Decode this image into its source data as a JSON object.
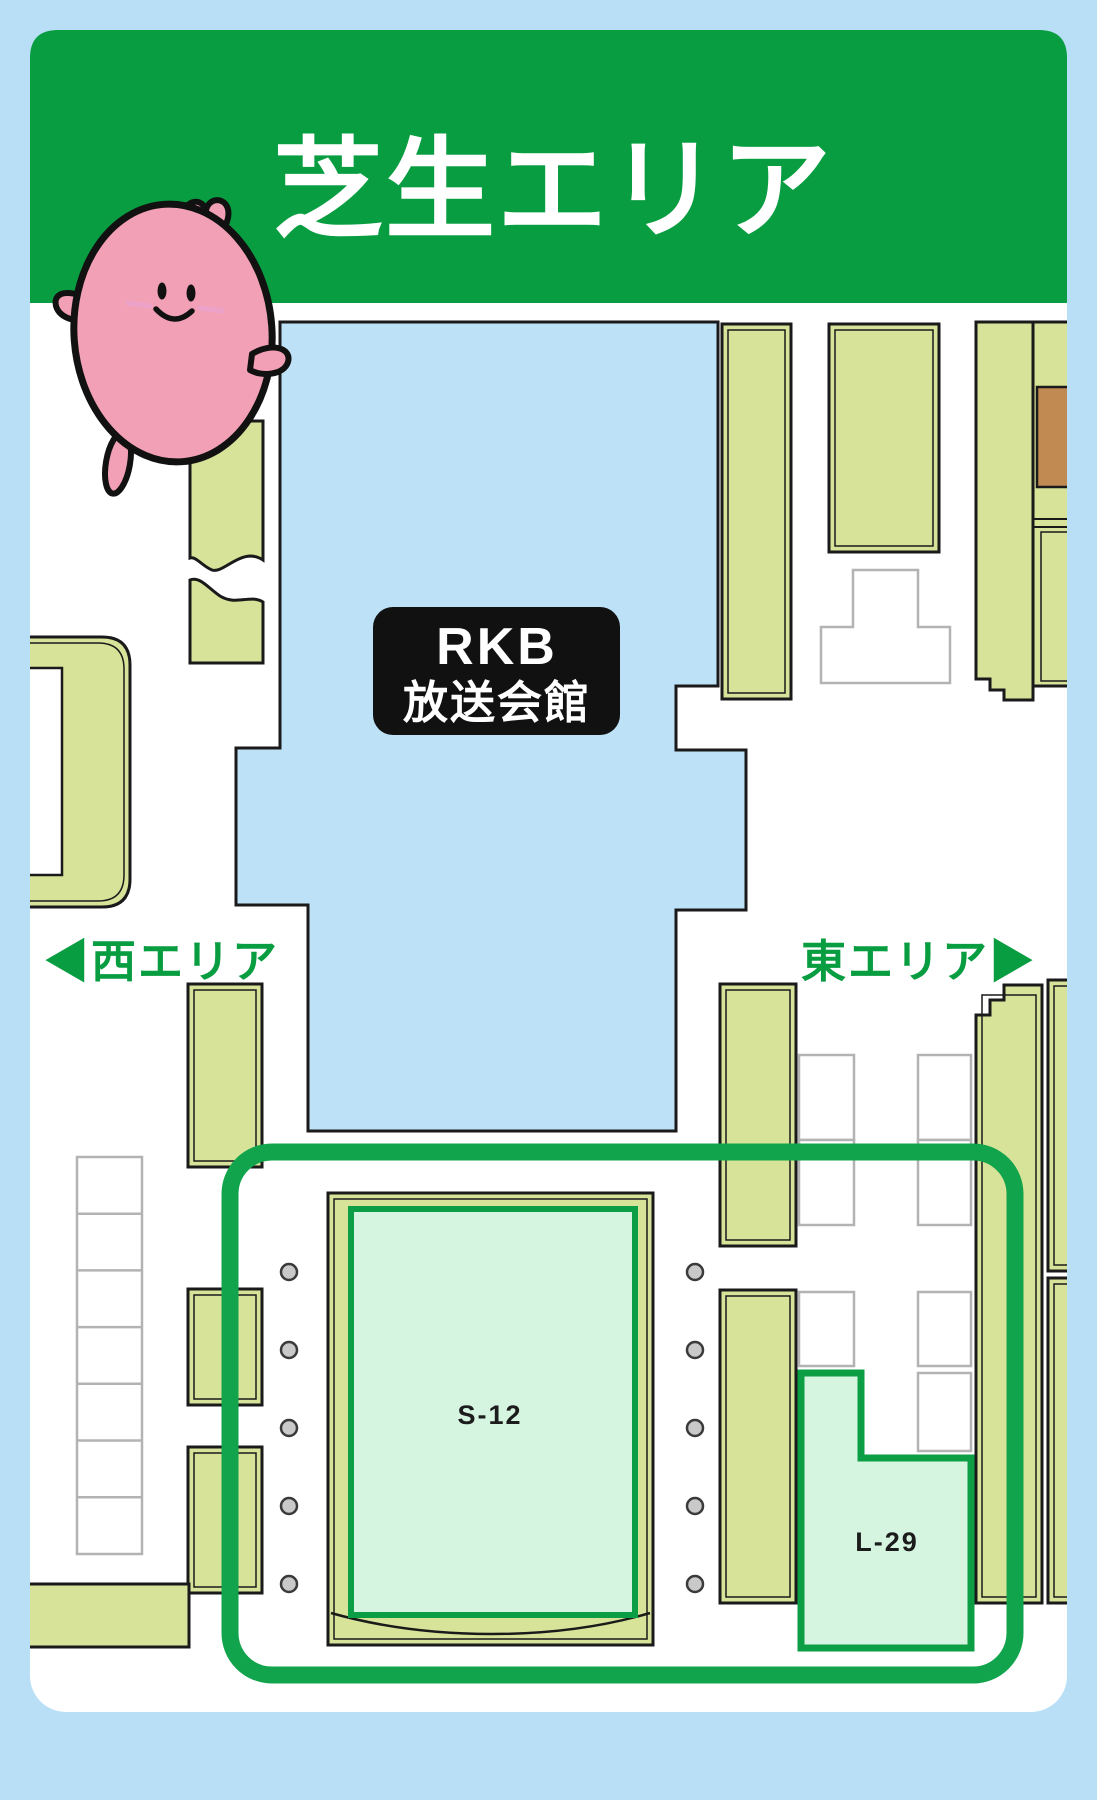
{
  "page": {
    "background_color": "#b9dff6"
  },
  "header": {
    "title": "芝生エリア",
    "background_color": "#089d40",
    "text_color": "#ffffff"
  },
  "building": {
    "label_line1": "RKB",
    "label_line2": "放送会館",
    "background_color": "#111111",
    "text_color": "#ffffff",
    "footprint_color": "#bde1f7"
  },
  "area_links": {
    "west_label": "◀西エリア",
    "east_label": "東エリア▶",
    "text_color": "#089d40"
  },
  "booths": {
    "s12": {
      "label": "S-12",
      "fill_color": "#d6f5e1",
      "border_color": "#0c9e44"
    },
    "l29": {
      "label": "L-29",
      "fill_color": "#d6f5e1",
      "border_color": "#0c9e44"
    }
  },
  "highlight": {
    "border_color": "#12a44c"
  },
  "map": {
    "ground_color": "#ffffff",
    "planter_color": "#d7e398",
    "accent_brown": "#c18a52",
    "outline_color": "#1a1a1a",
    "minor_outline_color": "#b3b3b3",
    "dot_color": "#c9c9c9"
  },
  "mascot": {
    "body_color": "#f2a0b5",
    "outline_color": "#111111"
  }
}
